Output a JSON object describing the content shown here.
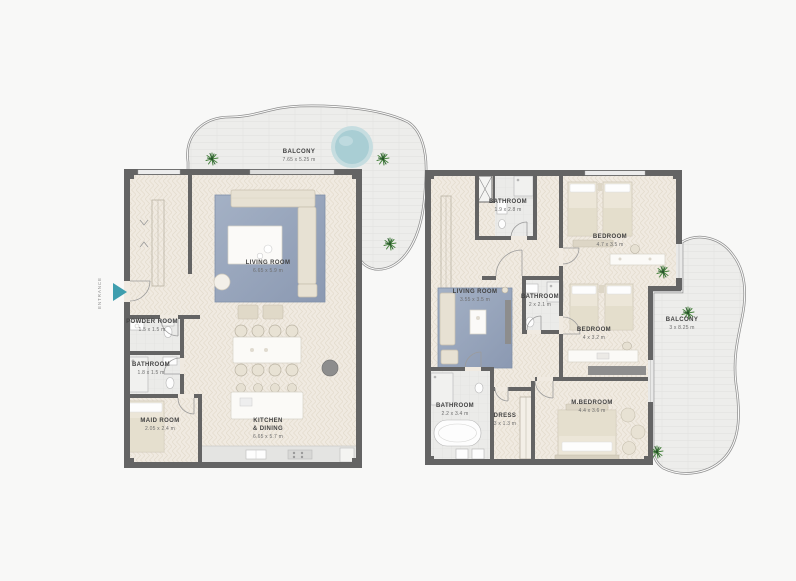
{
  "left_plan": {
    "entrance": "ENTRANCE",
    "balcony": {
      "name": "BALCONY",
      "dims": "7.65 x 5.25 m"
    },
    "living_room": {
      "name": "LIVING ROOM",
      "dims": "6.65 x 5.9 m"
    },
    "powder_room": {
      "name": "POWDER ROOM",
      "dims": "1.5 x 1.5 m"
    },
    "bathroom": {
      "name": "BATHROOM",
      "dims": "1.8 x 1.5 m"
    },
    "maid_room": {
      "name": "MAID ROOM",
      "dims": "2.05 x 2.4 m"
    },
    "kitchen": {
      "name": "KITCHEN\n& DINING",
      "dims": "6.65 x 5.7 m"
    }
  },
  "right_plan": {
    "bathroom_top": {
      "name": "BATHROOM",
      "dims": "1.9 x 2.8 m"
    },
    "bedroom_top": {
      "name": "BEDROOM",
      "dims": "4.7 x 3.5 m"
    },
    "living_room": {
      "name": "LIVING ROOM",
      "dims": "3.55 x 3.5 m"
    },
    "bathroom_mid": {
      "name": "BATHROOM",
      "dims": "2 x 2.1 m"
    },
    "bedroom_mid": {
      "name": "BEDROOM",
      "dims": "4 x 3.2 m"
    },
    "bathroom_master": {
      "name": "BATHROOM",
      "dims": "2.2 x 3.4 m"
    },
    "dress": {
      "name": "DRESS",
      "dims": "3 x 1.3 m"
    },
    "master_bedroom": {
      "name": "M.BEDROOM",
      "dims": "4.4 x 3.6 m"
    },
    "balcony": {
      "name": "BALCONY",
      "dims": "3 x 8.25 m"
    }
  },
  "colors": {
    "wall": "#646464",
    "floor": "#f0eae1",
    "balcony_floor": "#ededeb",
    "rug": "#97a5bb",
    "pool": "#a9ced4",
    "entrance_arrow": "#3f9eae",
    "plant": "#45813c"
  }
}
